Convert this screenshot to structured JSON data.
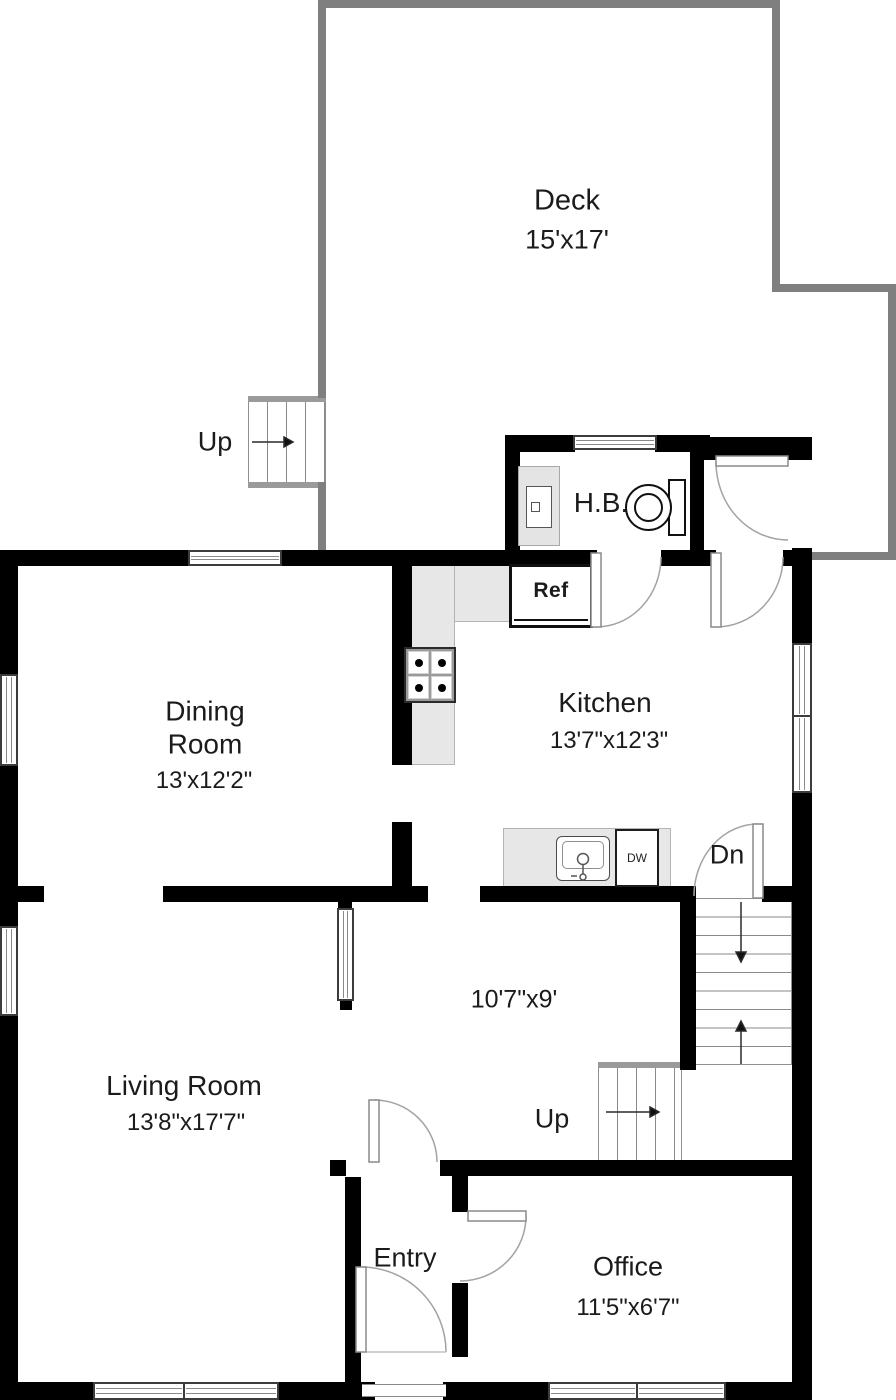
{
  "floorplan": {
    "rooms": {
      "deck": {
        "name": "Deck",
        "dims": "15'x17'"
      },
      "dining": {
        "name": "Dining Room",
        "dims": "13'x12'2\""
      },
      "kitchen": {
        "name": "Kitchen",
        "dims": "13'7\"x12'3\""
      },
      "living": {
        "name": "Living Room",
        "dims": "13'8\"x17'7\""
      },
      "hall": {
        "dims": "10'7\"x9'"
      },
      "entry": {
        "name": "Entry"
      },
      "office": {
        "name": "Office",
        "dims": "11'5\"x6'7\""
      },
      "half_bath": {
        "abbr": "H.B."
      }
    },
    "stairs": {
      "up": "Up",
      "down": "Dn"
    },
    "appliances": {
      "refrigerator": "Ref",
      "dishwasher": "DW"
    },
    "colors": {
      "wall": "#000000",
      "deck_wall": "#7f7f7f",
      "counter": "#e7e7e7"
    }
  }
}
